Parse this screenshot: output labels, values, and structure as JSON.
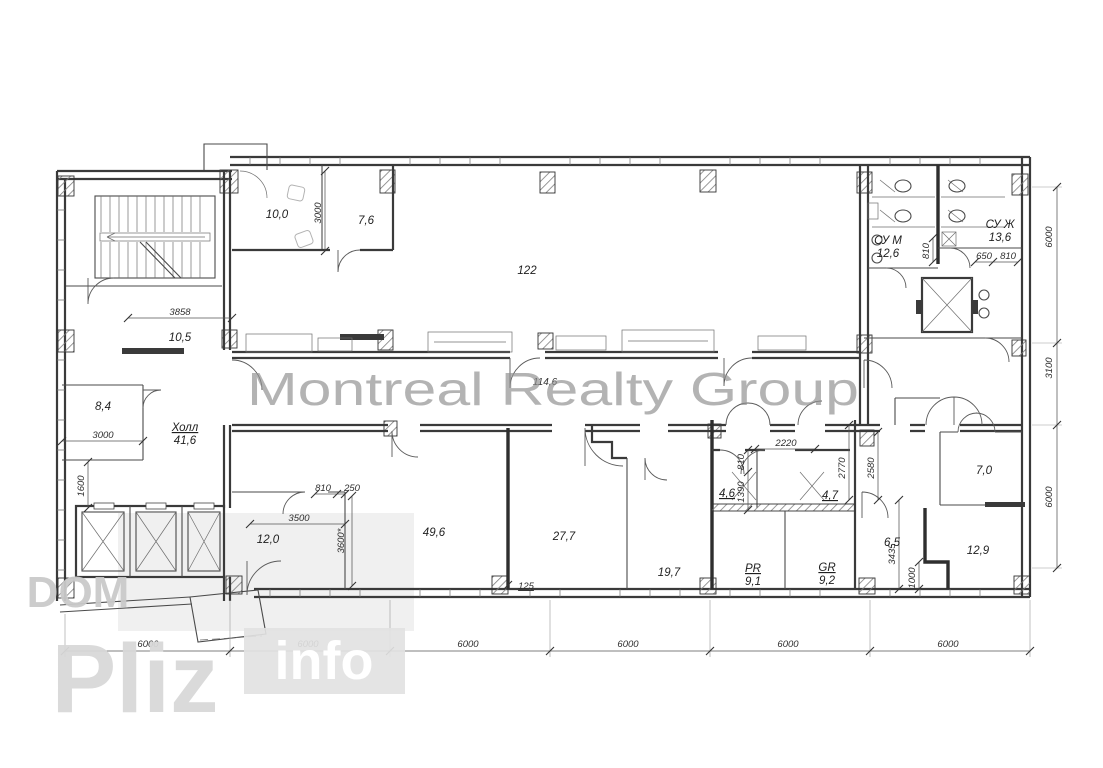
{
  "watermarks": {
    "center": "Montreal Realty Group",
    "dom": "DOM",
    "pliz": "Pliz",
    "info": "info"
  },
  "rooms": {
    "cab10_0": {
      "area": "10,0"
    },
    "cab7_6": {
      "area": "7,6"
    },
    "hall122": {
      "area": "122"
    },
    "corr10_5": {
      "area": "10,5"
    },
    "cab8_4": {
      "area": "8,4"
    },
    "hall": {
      "name": "Холл",
      "area": "41,6"
    },
    "corr114_6": {
      "area": "114,6"
    },
    "cab12_0": {
      "area": "12,0"
    },
    "cab49_6": {
      "area": "49,6"
    },
    "cab27_7": {
      "area": "27,7"
    },
    "cab19_7": {
      "area": "19,7"
    },
    "pr": {
      "name": "PR",
      "area": "9,1"
    },
    "gr": {
      "name": "GR",
      "area": "9,2"
    },
    "cab4_6": {
      "area": "4,6"
    },
    "cab4_7": {
      "area": "4,7"
    },
    "cab6_5": {
      "area": "6,5"
    },
    "cab12_9": {
      "area": "12,9"
    },
    "cab7_0": {
      "area": "7,0"
    },
    "wc_m": {
      "name": "СУ М",
      "area": "12,6"
    },
    "wc_f": {
      "name": "СУ Ж",
      "area": "13,6"
    }
  },
  "dims": {
    "bottom": [
      "6000",
      "6000",
      "6000",
      "6000",
      "6000",
      "6000"
    ],
    "right": [
      "6000",
      "3100",
      "6000"
    ],
    "d3858": "3858",
    "d3000_v": "3000",
    "d3000_h": "3000",
    "d1600": "1600",
    "d3500": "3500",
    "d810_a": "810",
    "d250": "250",
    "d3600": "3600*",
    "d125": "125",
    "d2220": "2220",
    "d810_b": "810",
    "d1390": "1390",
    "d2770": "2770",
    "d2580": "2580",
    "d3435": "3435",
    "d1000": "1000",
    "d650": "650",
    "d810_c": "810",
    "d810_d": "810"
  }
}
